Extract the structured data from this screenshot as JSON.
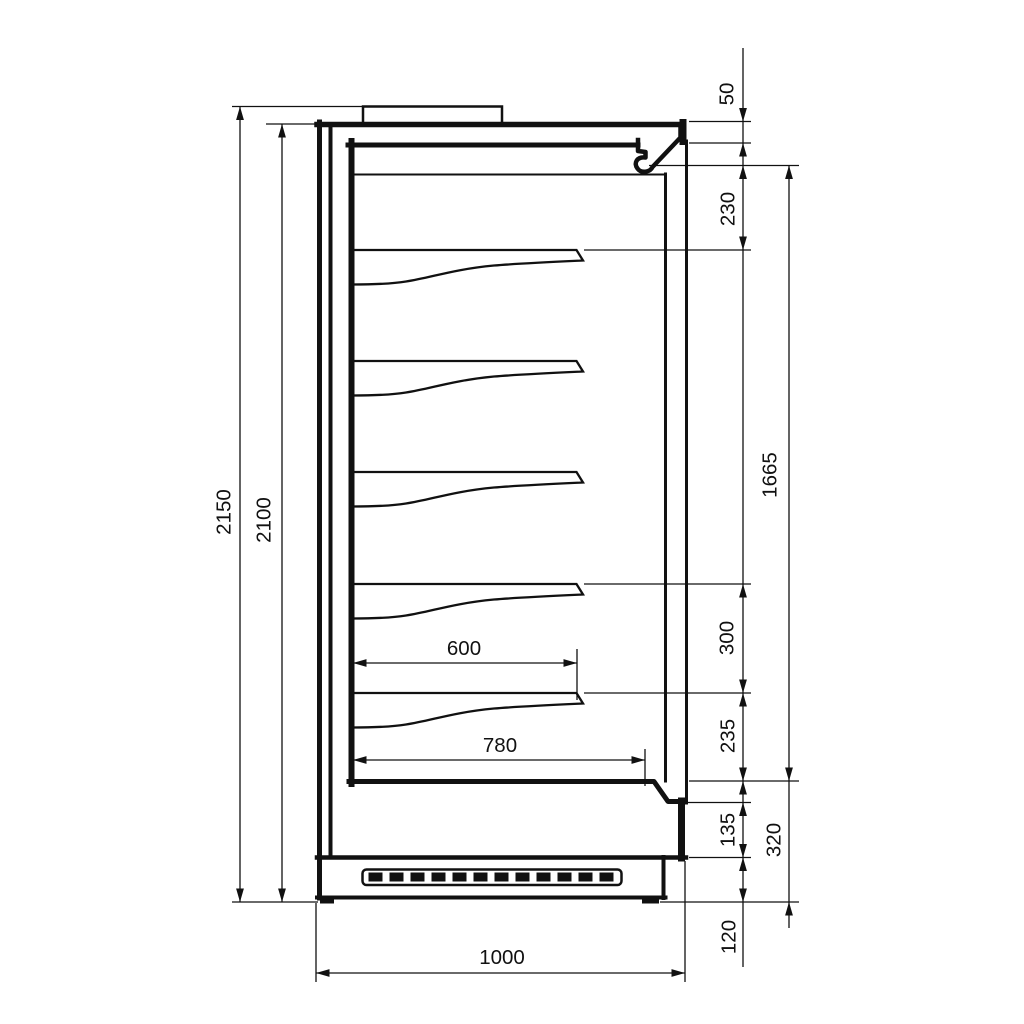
{
  "drawing": {
    "type": "technical side-section drawing of a multideck refrigerated display cabinet",
    "dims": {
      "overall_height": "2150",
      "body_height": "2100",
      "top_clearance": "50",
      "canopy_to_first_shelf": "230",
      "display_opening_height": "1665",
      "shelf_spacing": "300",
      "bottom_shelf_clearance": "235",
      "air_outlet_height": "135",
      "base_section_height": "320",
      "plinth_height": "120",
      "shelf_depth": "600",
      "deck_depth": "780",
      "overall_depth": "1000"
    },
    "colors": {
      "line": "#111111",
      "background": "#ffffff"
    }
  }
}
